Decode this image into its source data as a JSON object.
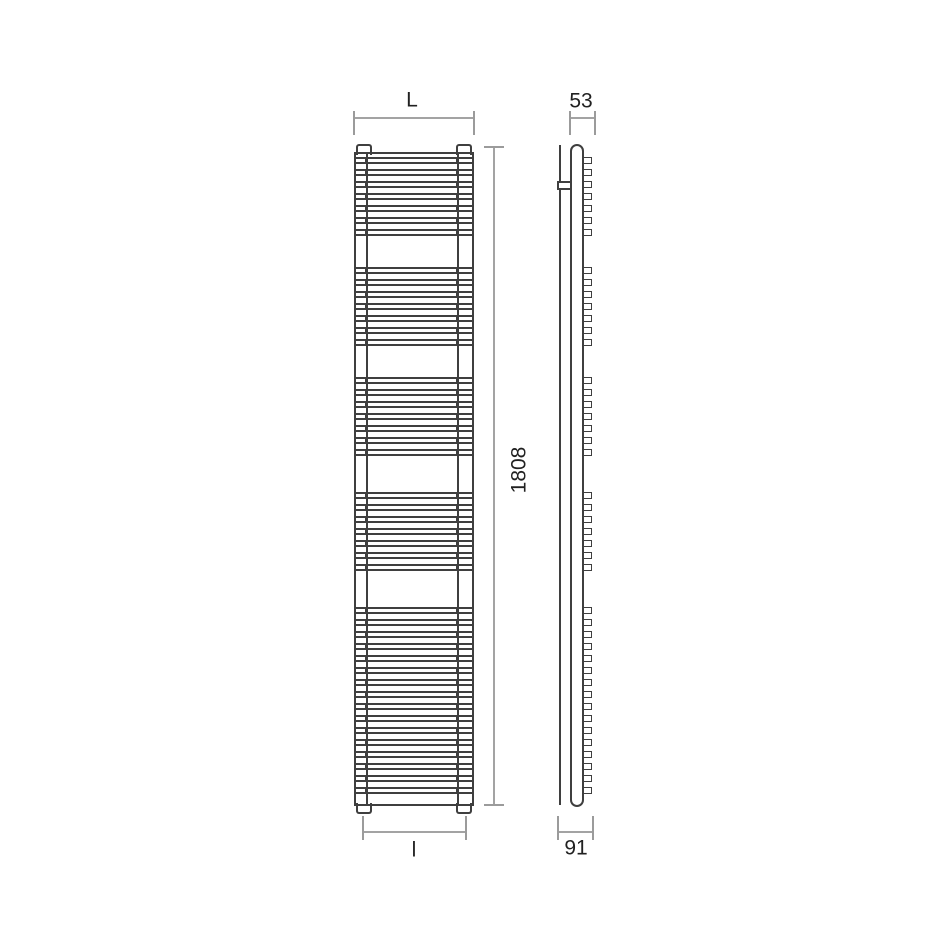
{
  "drawing": {
    "title": "towel radiator technical drawing, front and side elevation",
    "background": "#ffffff",
    "colors": {
      "object_stroke": "#3f3f3f",
      "dimension_stroke": "#a3a3a3",
      "label_text": "#212121"
    },
    "labels": {
      "overall_width_top": "L",
      "depth_top": "53",
      "overall_height": "1808",
      "width_bottom": "l",
      "wall_depth_bottom": "91"
    },
    "front_view": {
      "body": {
        "x": 354,
        "y": 152,
        "w": 120,
        "h": 654
      },
      "collector_xs": [
        366,
        457
      ],
      "tabs": {
        "xs": [
          356,
          456
        ],
        "w": 16,
        "h": 9
      },
      "rung_height": 7,
      "rung_pitch": 12,
      "rung_groups": [
        {
          "y": 157,
          "count": 7
        },
        {
          "y": 267,
          "count": 7
        },
        {
          "y": 377,
          "count": 7
        },
        {
          "y": 492,
          "count": 7
        },
        {
          "y": 607,
          "count": 16
        }
      ]
    },
    "side_view": {
      "wall_line": {
        "x": 559,
        "y": 145,
        "w": 2,
        "h": 660
      },
      "bracket": {
        "x": 557,
        "y": 181,
        "w": 15,
        "h": 9
      },
      "body": {
        "x": 570,
        "y": 144,
        "w": 14,
        "h": 663,
        "radius": 7
      },
      "fin": {
        "x": 582,
        "w": 10
      }
    }
  }
}
